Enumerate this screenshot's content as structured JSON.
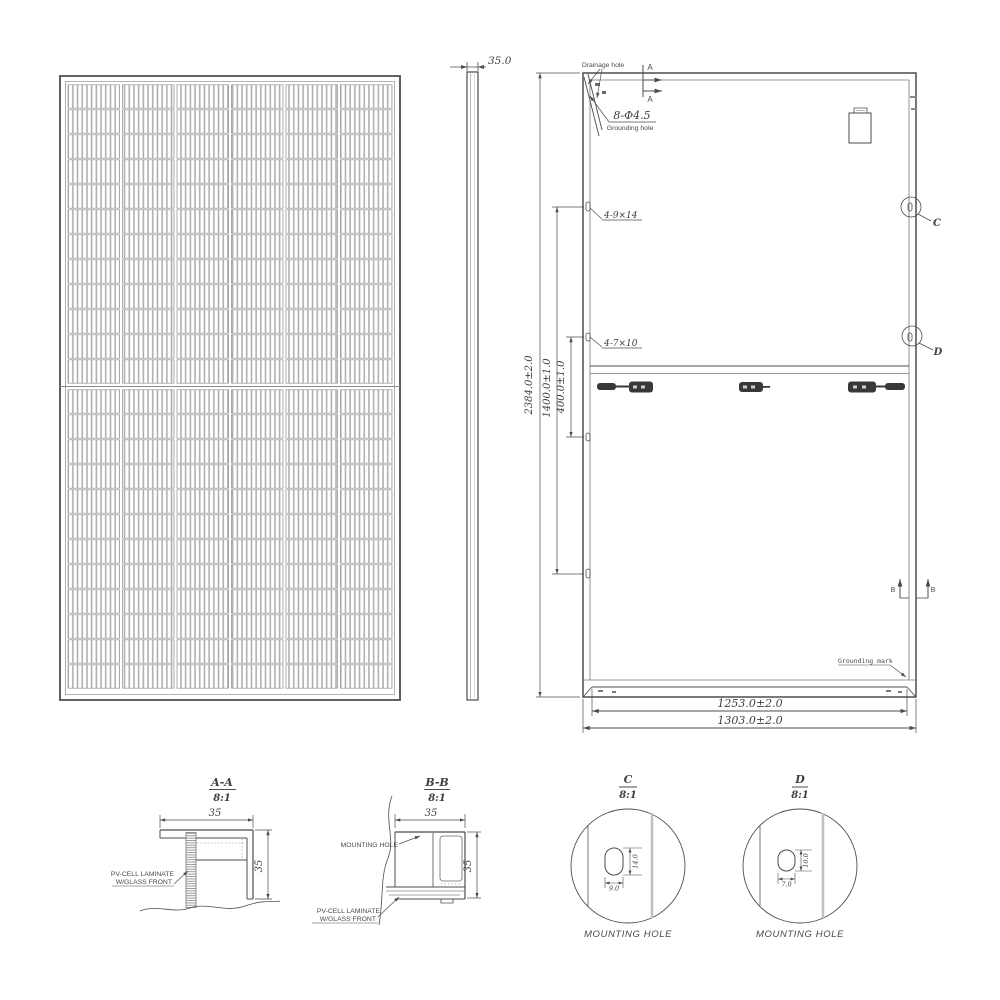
{
  "front_view": {
    "columns": 6,
    "rows": 24
  },
  "side_view": {
    "thickness_dim": "35.0"
  },
  "back_view": {
    "drainage_hole_label": "Drainage hole",
    "grounding_hole_spec": "8-Φ4.5",
    "grounding_hole_label": "Grounding hole",
    "slot_label_top": "4-9×14",
    "slot_label_bottom": "4-7×10",
    "grounding_mark_label": "Grounding mark",
    "section_a_label": "A",
    "section_b_label": "B",
    "detail_c_label": "C",
    "detail_d_label": "D",
    "dim_height": "2384.0±2.0",
    "dim_mount_span_outer": "1400.0±1.0",
    "dim_mount_span_inner": "400.0±1.0",
    "dim_flange_width": "1253.0±2.0",
    "dim_width": "1303.0±2.0"
  },
  "detail_aa": {
    "title": "A-A",
    "scale": "8:1",
    "dim_width": "35",
    "dim_height": "35",
    "laminate_line1": "PV-CELL LAMINATE",
    "laminate_line2": "W/GLASS FRONT"
  },
  "detail_bb": {
    "title": "B-B",
    "scale": "8:1",
    "dim_width": "35",
    "dim_height": "35",
    "mounting_hole_label": "MOUNTING HOLE",
    "laminate_line1": "PV-CELL LAMINATE",
    "laminate_line2": "W/GLASS FRONT"
  },
  "detail_c": {
    "title": "C",
    "scale": "8:1",
    "dim_height": "14.0",
    "dim_width": "9.0",
    "caption": "MOUNTING HOLE"
  },
  "detail_d": {
    "title": "D",
    "scale": "8:1",
    "dim_height": "10.0",
    "dim_width": "7.0",
    "caption": "MOUNTING HOLE"
  }
}
